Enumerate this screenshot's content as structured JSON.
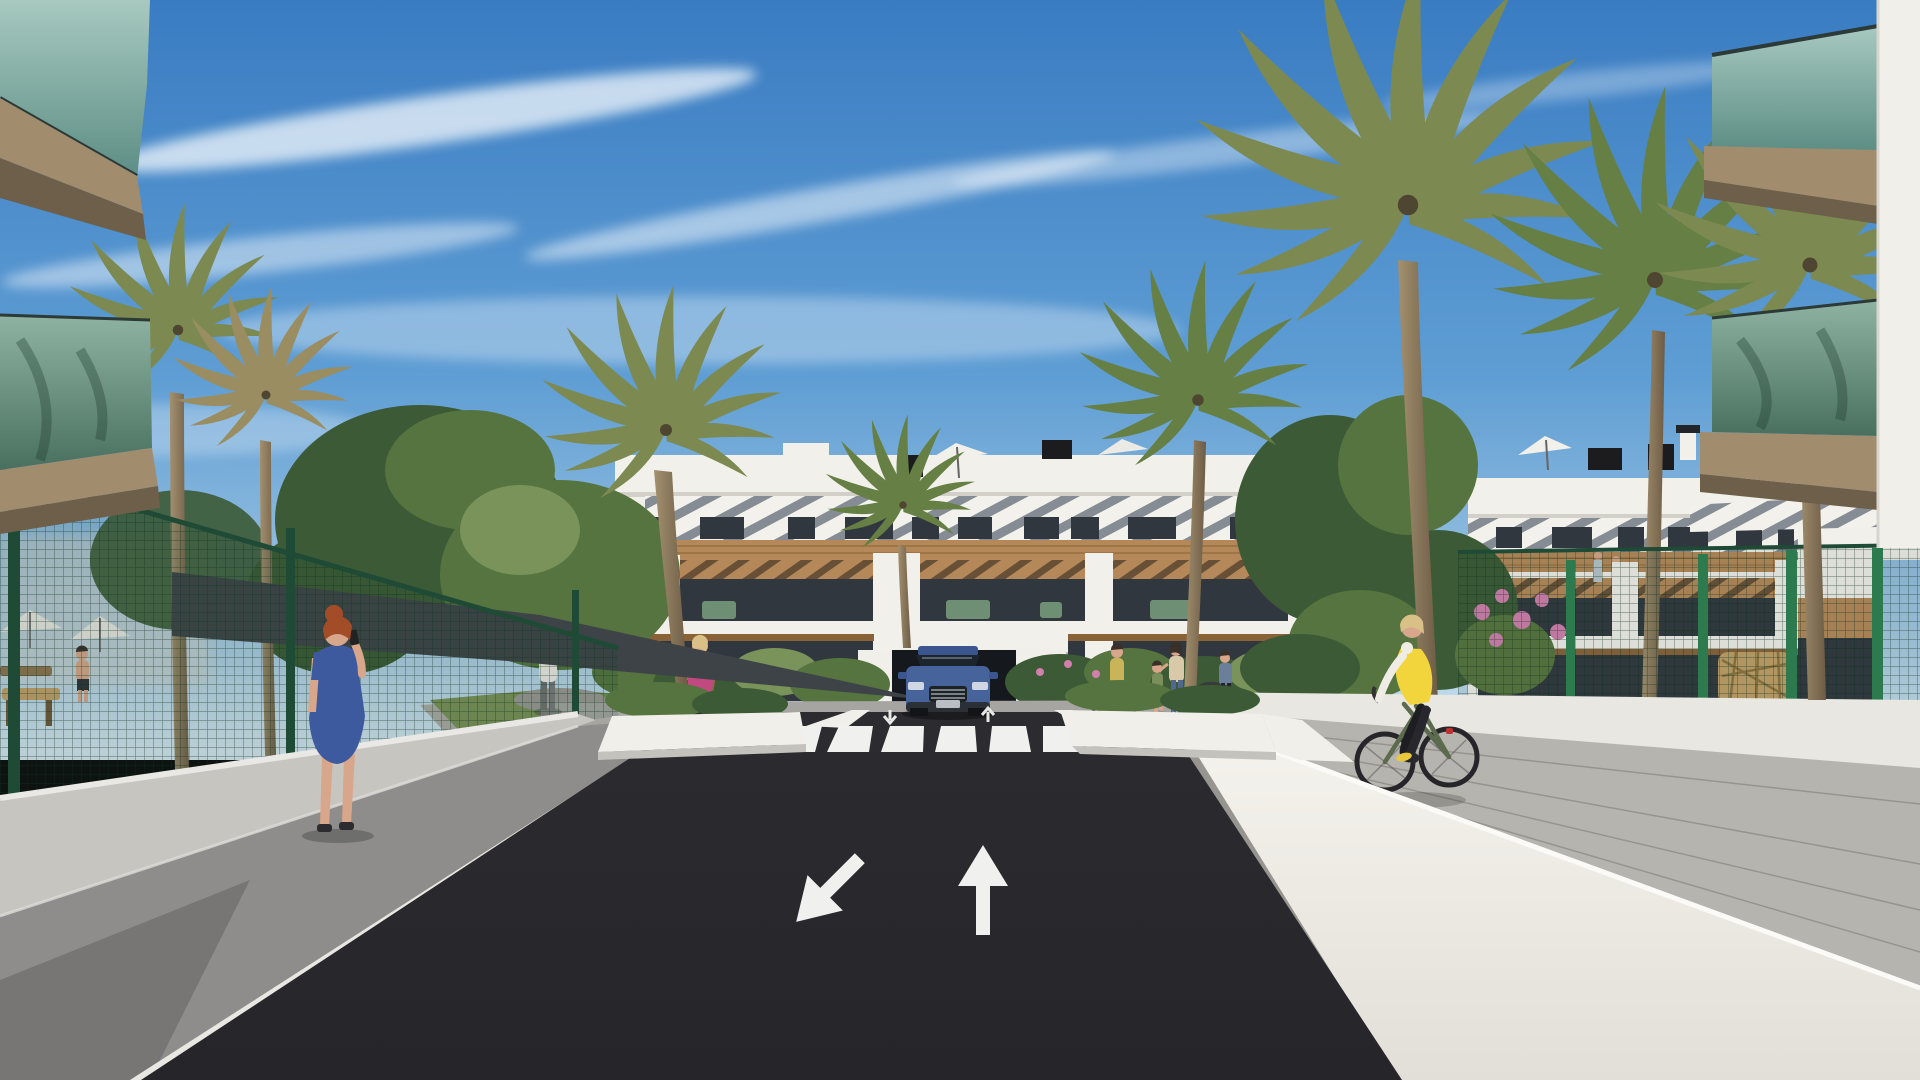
{
  "scene": {
    "type": "architectural-exterior-render",
    "elements": [
      "sky with cirrus clouds",
      "central apartment building",
      "right apartment building",
      "foreground glass balconies left",
      "foreground glass balconies right",
      "palm trees",
      "green garden fences",
      "access road with crosswalk",
      "underground garage entrance with car",
      "flanking white walls and sidewalks",
      "pedestrians",
      "cyclist"
    ]
  },
  "road_markings": {
    "left_lane_arrow": "down-left",
    "right_lane_arrow": "up",
    "crosswalk_stripe_count": 6
  },
  "vehicle": {
    "type": "suv",
    "color_name": "blue",
    "location": "garage ramp"
  },
  "figures": [
    {
      "name": "woman-blue-dress",
      "detail": "red hair, phone to ear, left sidewalk"
    },
    {
      "name": "cyclist",
      "detail": "yellow vest, white sleeves, green bicycle, right path"
    },
    {
      "name": "man-white-top",
      "detail": "garden path left"
    },
    {
      "name": "woman-pink-jacket",
      "detail": "brown handbag, center path"
    },
    {
      "name": "woman-with-bicycle",
      "detail": "near bike racks"
    },
    {
      "name": "adult-with-child",
      "detail": "near bike racks"
    },
    {
      "name": "pedestrian",
      "detail": "right of bike racks"
    },
    {
      "name": "man-in-garden",
      "detail": "behind left fence"
    }
  ],
  "palette": {
    "sky_top": "#3a7cc2",
    "sky_mid": "#5f9ed4",
    "sky_low": "#a9cbe4",
    "building_white": "#f2f0ea",
    "building_shade": "#dbd8d0",
    "stripe_gray": "#868c93",
    "wood": "#b5885a",
    "wood_dark": "#8a6238",
    "glass_dark": "#31373e",
    "slab_tan": "#a18c6e",
    "slab_dark": "#6e5f4a",
    "glass_teal_hi": "#a7c9c0",
    "glass_teal_lo": "#5c8d84",
    "glass_green_hi": "#8fb3a2",
    "glass_green_lo": "#49705f",
    "road_asphalt": "#26262a",
    "road_marking": "#f0f0ee",
    "sidewalk_shade": "#8e8d8b",
    "sidewalk_light": "#b6b4ae",
    "wall_bright": "#f1efe9",
    "wall_gray": "#c7c5c0",
    "fence_dark": "#1e4a36",
    "fence_post": "#2c7a4d",
    "foliage_dark": "#3c5a35",
    "foliage_mid": "#56743f",
    "foliage_light": "#79935a",
    "palm_olive": "#7c8a52",
    "palm_green": "#667f45",
    "palm_dry": "#9a8d62",
    "trunk_light": "#a3906f",
    "trunk_dark": "#6d5c46",
    "grass": "#7b9157",
    "flower_pink": "#d27fae",
    "flower_orange": "#d2763a",
    "car_blue": "#46639c",
    "car_blue_dark": "#3b568e",
    "car_glass": "#1c242e",
    "skin": "#d8a68a",
    "hair_red": "#a34d28",
    "hair_blonde": "#d9c087",
    "hair_dark": "#3a302a",
    "dress_blue": "#3d5a9e",
    "vest_yellow": "#f2d53d",
    "jacket_pink": "#c04a80",
    "pants_dark": "#23232a",
    "jeans": "#50678f",
    "bike_frame": "#5c6b4e",
    "bench_wood": "#c2a068",
    "shade_sail": "#3e4347"
  }
}
